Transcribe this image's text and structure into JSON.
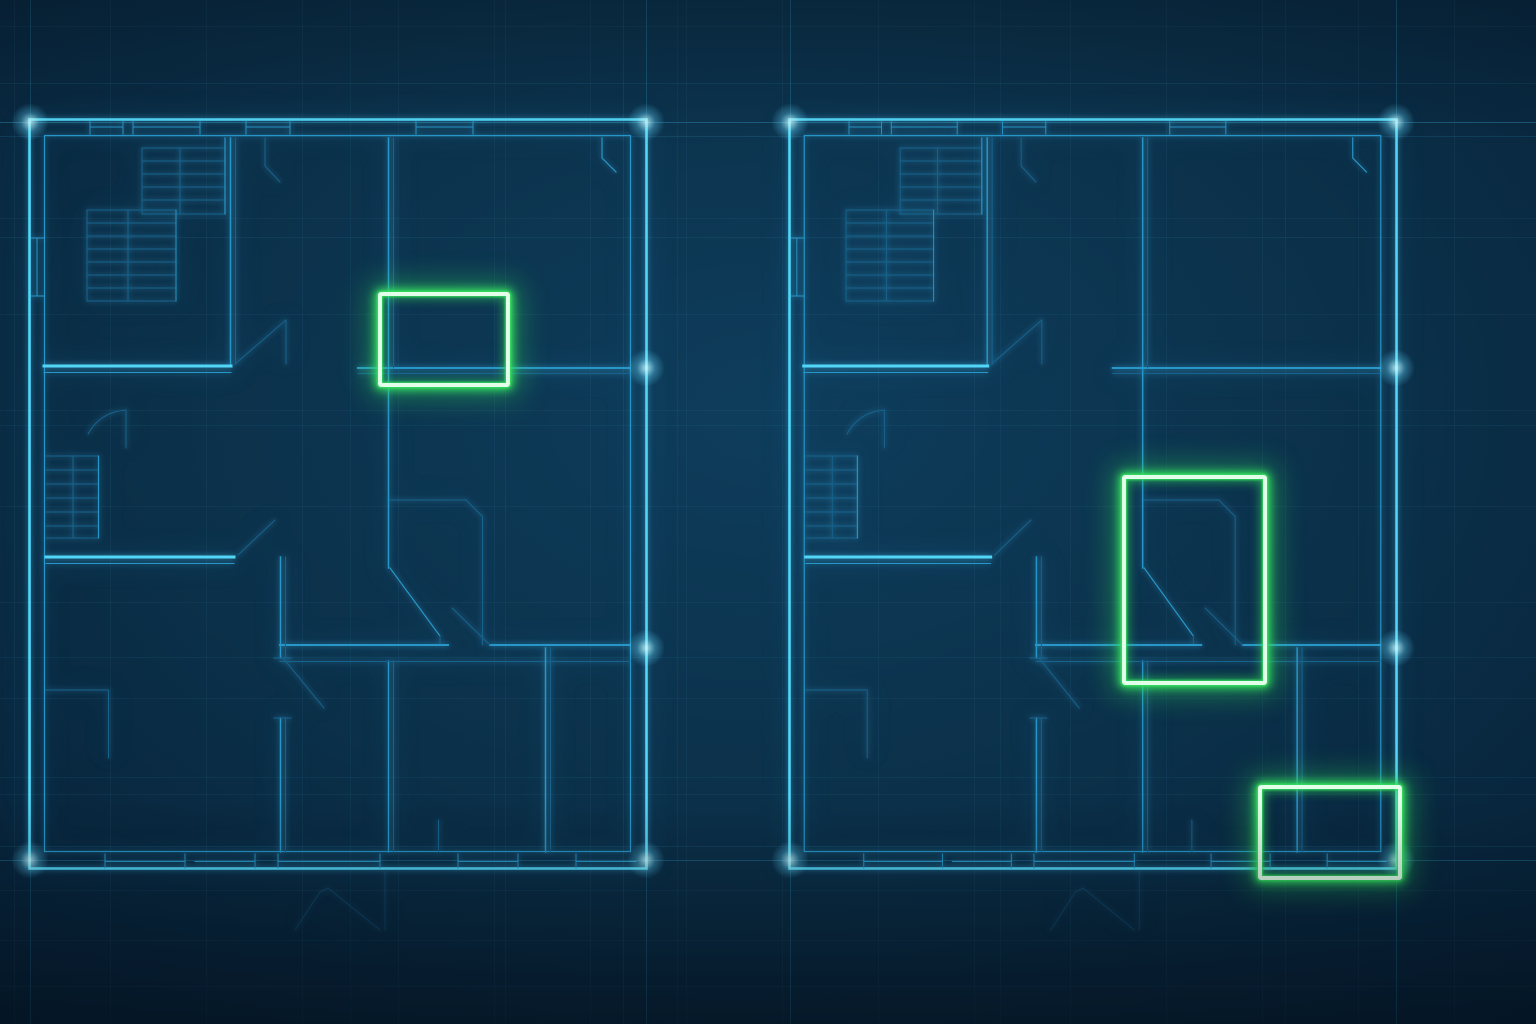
{
  "scene": {
    "description": "Two glowing blueprint floor plans side by side on a dark navy background, with neon green rectangles highlighting rooms",
    "canvas": {
      "width": 1536,
      "height": 1024
    },
    "colors": {
      "line_bright": "#52d6f7",
      "line_mid": "#2796c8",
      "line_faint": "#17638f",
      "highlight_green": "#36e160",
      "highlight_core": "#e2ffe9",
      "background_center": "#0e3d5c",
      "background_edge": "#051a2d"
    },
    "grid": {
      "size": 96,
      "opacity": 0.055
    }
  },
  "plans": [
    {
      "id": "floorplan-left",
      "x": 28,
      "y": 118,
      "width": 620,
      "height": 752
    },
    {
      "id": "floorplan-right",
      "x": 788,
      "y": 118,
      "width": 610,
      "height": 752
    }
  ],
  "highlights": [
    {
      "id": "highlight-left-room",
      "plan": "floorplan-left",
      "x": 378,
      "y": 292,
      "width": 132,
      "height": 95
    },
    {
      "id": "highlight-right-room-large",
      "plan": "floorplan-right",
      "x": 1122,
      "y": 475,
      "width": 145,
      "height": 210
    },
    {
      "id": "highlight-right-room-small",
      "plan": "floorplan-right",
      "x": 1258,
      "y": 785,
      "width": 144,
      "height": 95
    }
  ],
  "construction_lines": {
    "horizontal": [
      {
        "y": 83,
        "opacity": 0.1
      },
      {
        "y": 122,
        "opacity": 0.26
      },
      {
        "y": 136,
        "opacity": 0.13
      },
      {
        "y": 237,
        "opacity": 0.09
      },
      {
        "y": 425,
        "opacity": 0.07
      },
      {
        "y": 657,
        "opacity": 0.07
      },
      {
        "y": 777,
        "opacity": 0.07
      },
      {
        "y": 846,
        "opacity": 0.1
      },
      {
        "y": 860,
        "opacity": 0.26
      },
      {
        "y": 940,
        "opacity": 0.06
      }
    ],
    "vertical": [
      {
        "x": 30,
        "opacity": 0.2
      },
      {
        "x": 350,
        "opacity": 0.06
      },
      {
        "x": 505,
        "opacity": 0.07
      },
      {
        "x": 623,
        "opacity": 0.1
      },
      {
        "x": 646,
        "opacity": 0.24
      },
      {
        "x": 677,
        "opacity": 0.06
      },
      {
        "x": 790,
        "opacity": 0.24
      },
      {
        "x": 1000,
        "opacity": 0.06
      },
      {
        "x": 1285,
        "opacity": 0.07
      },
      {
        "x": 1396,
        "opacity": 0.24
      }
    ]
  },
  "flares": [
    {
      "x": 30,
      "y": 122
    },
    {
      "x": 646,
      "y": 122
    },
    {
      "x": 790,
      "y": 122
    },
    {
      "x": 1396,
      "y": 122
    },
    {
      "x": 30,
      "y": 860
    },
    {
      "x": 646,
      "y": 860
    },
    {
      "x": 790,
      "y": 860
    },
    {
      "x": 1396,
      "y": 860
    },
    {
      "x": 646,
      "y": 368
    },
    {
      "x": 1396,
      "y": 368
    },
    {
      "x": 646,
      "y": 648
    },
    {
      "x": 1396,
      "y": 648
    }
  ]
}
